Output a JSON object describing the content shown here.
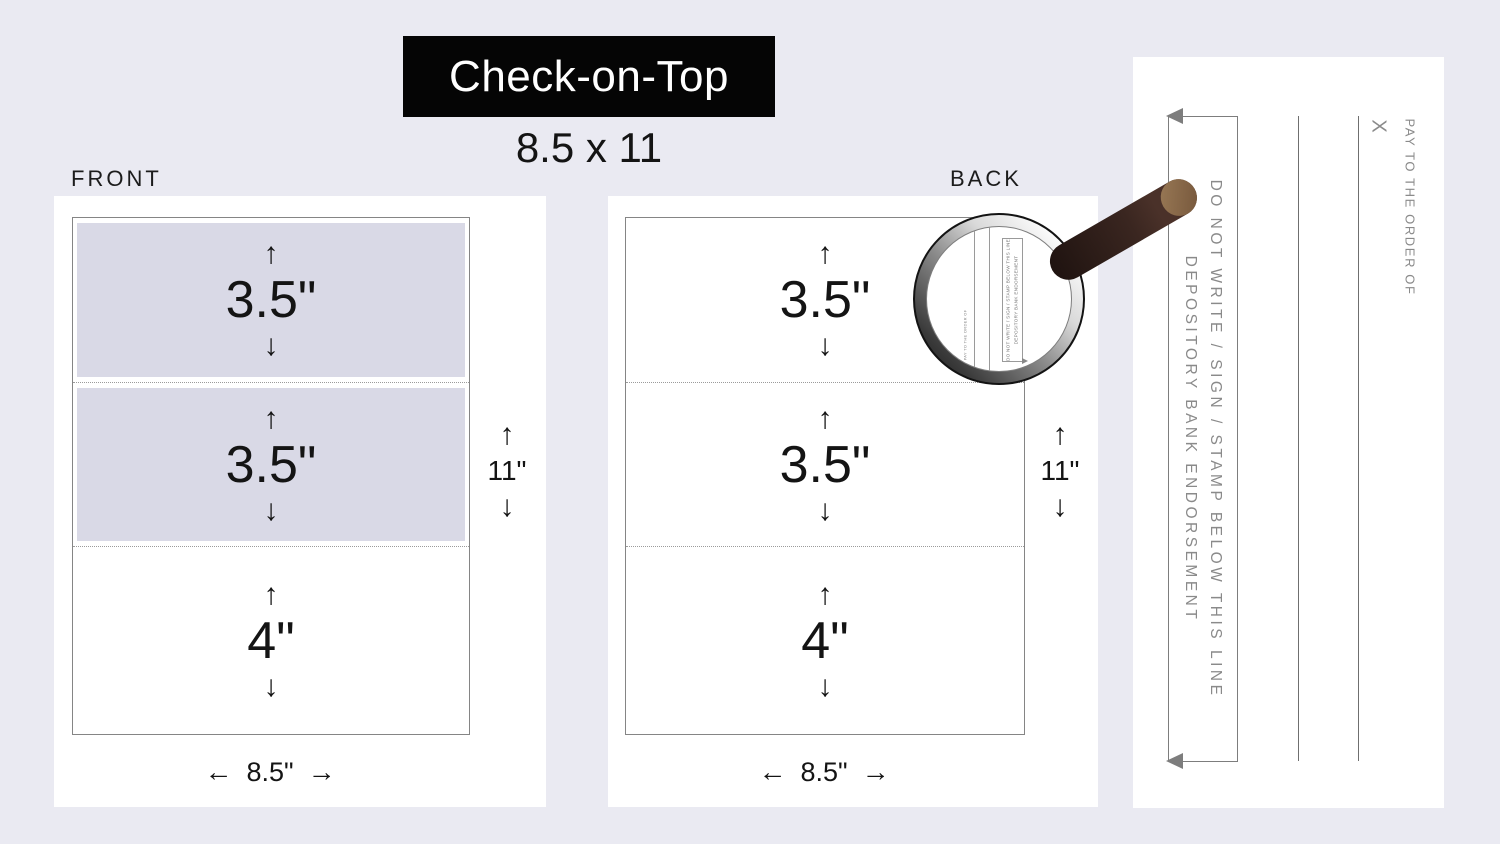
{
  "title": "Check-on-Top",
  "subtitle": "8.5 x 11",
  "front": {
    "label": "FRONT",
    "sections": [
      {
        "height_label": "3.5\"",
        "shaded": true
      },
      {
        "height_label": "3.5\"",
        "shaded": true
      },
      {
        "height_label": "4\"",
        "shaded": false
      }
    ],
    "height_label": "11\"",
    "width_label": "8.5\""
  },
  "back": {
    "label": "BACK",
    "sections": [
      {
        "height_label": "3.5\"",
        "shaded": false
      },
      {
        "height_label": "3.5\"",
        "shaded": false
      },
      {
        "height_label": "4\"",
        "shaded": false
      }
    ],
    "height_label": "11\"",
    "width_label": "8.5\""
  },
  "check_back": {
    "endorsement_line1": "DO NOT WRITE / SIGN / STAMP BELOW THIS LINE",
    "endorsement_line2": "DEPOSITORY BANK ENDORSEMENT",
    "pay_to_label": "PAY TO THE ORDER OF",
    "x_mark": "X"
  },
  "magnifier": {
    "mini_endorsement_line1": "DO NOT WRITE / SIGN / STAMP BELOW THIS LINE",
    "mini_endorsement_line2": "DEPOSITORY BANK ENDORSEMENT",
    "mini_pay_to_label": "PAY TO THE ORDER OF"
  },
  "icons": {
    "arrow_up": "↑",
    "arrow_down": "↓",
    "arrow_left": "←",
    "arrow_right": "→"
  },
  "colors": {
    "background": "#eaeaf2",
    "section_shade": "#d9d9e6",
    "title_background": "#050505",
    "title_text": "#ffffff",
    "body_text": "#141414",
    "check_gray_text": "#8a8a8a",
    "border_gray": "#7d7d7d",
    "handle_dark_brown": "#3a2620",
    "handle_tip_brown": "#8d6e4e"
  }
}
